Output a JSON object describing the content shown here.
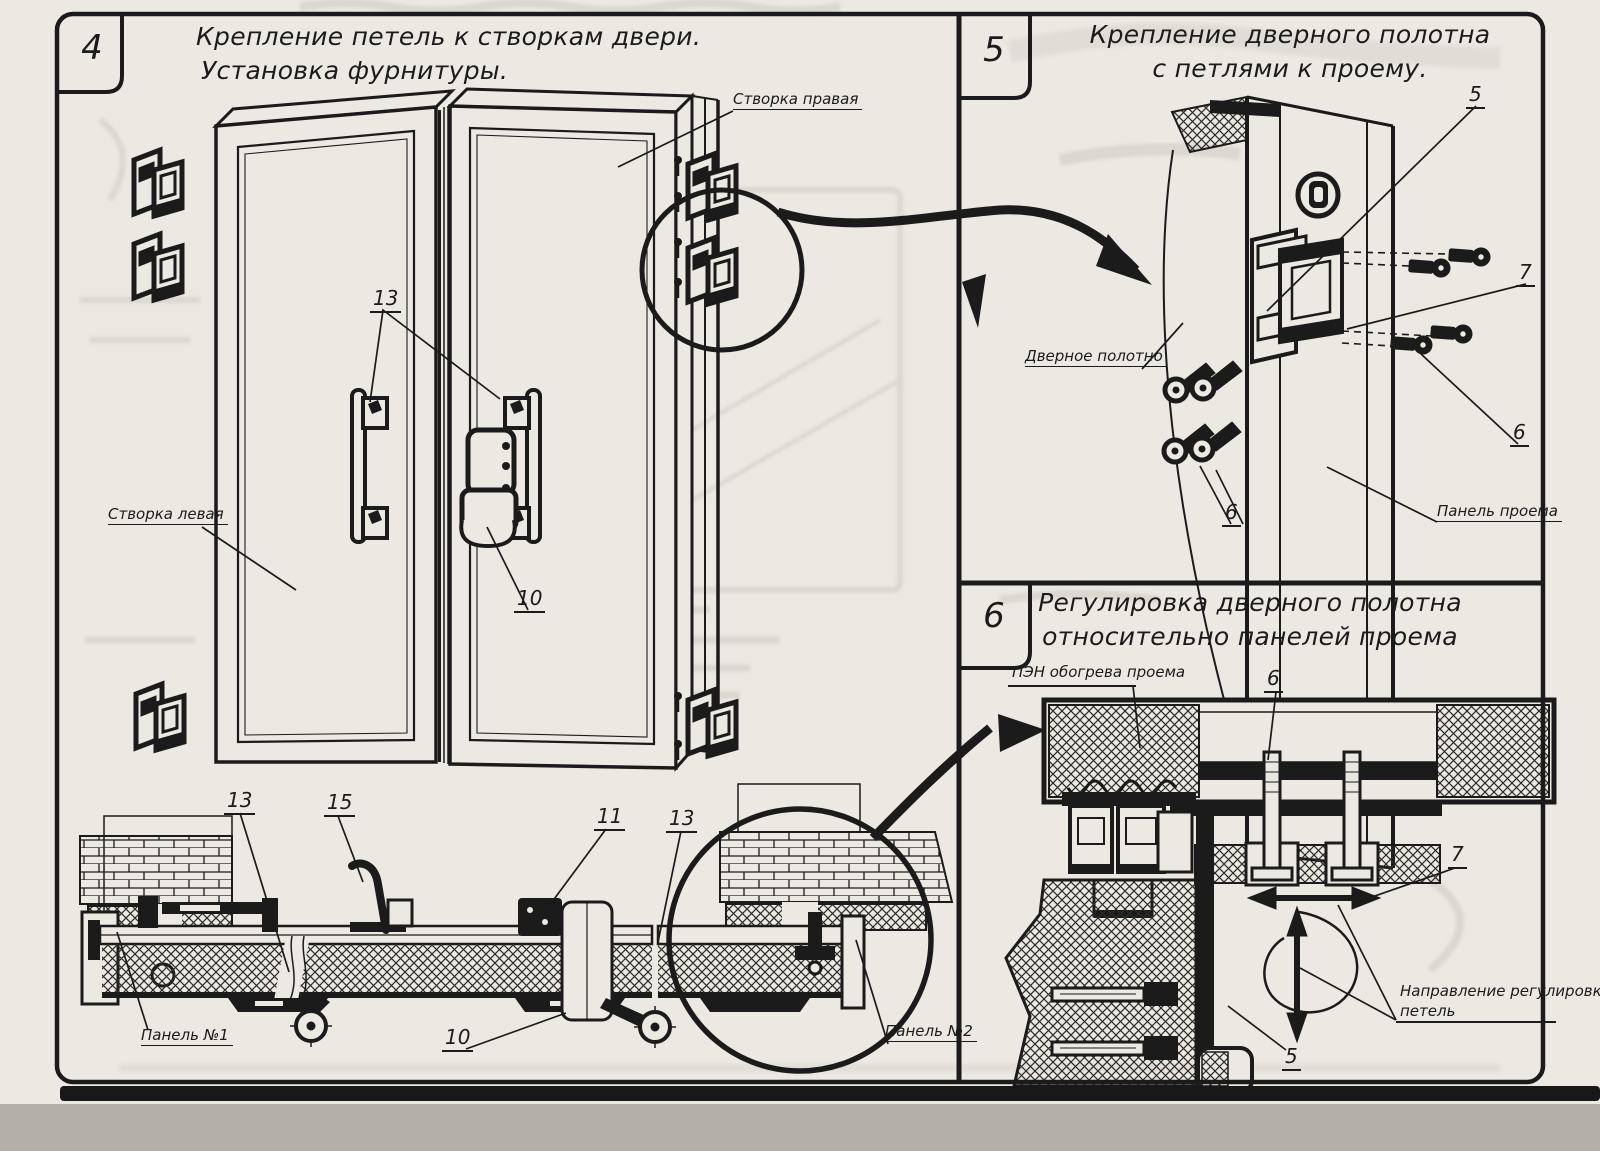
{
  "colors": {
    "paper": "#ece9e2",
    "ink": "#1b1b1b",
    "ghost": "#c9c6be",
    "scan_bar": "#181818"
  },
  "panel4": {
    "number": "4",
    "title_line1": "Крепление петель к створкам двери.",
    "title_line2": "Установка фурнитуры.",
    "labels": {
      "right_leaf": "Створка правая",
      "left_leaf": "Створка левая",
      "panel_1": "Панель №1",
      "panel_2": "Панель №2"
    },
    "callouts": {
      "handles": "13",
      "lock": "10",
      "section_left": "13",
      "bracket": "15",
      "lock_section": "11",
      "section_right": "13",
      "lock_bottom": "10"
    }
  },
  "panel5": {
    "number": "5",
    "title_line1": "Крепление дверного полотна",
    "title_line2": "с петлями к проему.",
    "labels": {
      "door_leaf": "Дверное полотно",
      "opening_panel": "Панель проема"
    },
    "callouts": {
      "hinge": "5",
      "pin": "7",
      "screws_right": "6",
      "screws_left": "6"
    }
  },
  "panel6": {
    "number": "6",
    "title_line1": "Регулировка дверного полотна",
    "title_line2": "относительно панелей проема",
    "labels": {
      "heater": "ПЭН обогрева проема",
      "direction_line1": "Направление регулировки",
      "direction_line2": "петель"
    },
    "callouts": {
      "bolt": "6",
      "pin": "7",
      "hinge": "5"
    }
  }
}
